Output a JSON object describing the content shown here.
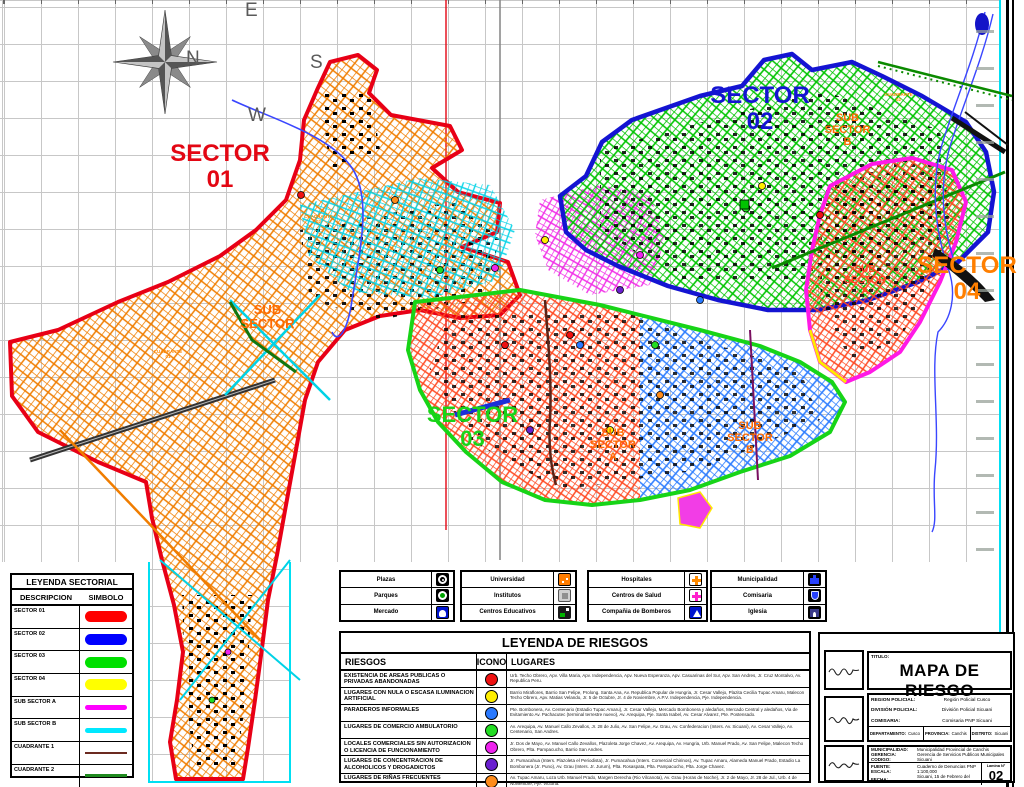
{
  "compass": {
    "n": "N",
    "e": "E",
    "s": "S",
    "w": "W"
  },
  "colors": {
    "sector01": "#e80016",
    "sector02": "#1414d2",
    "sector03": "#17d417",
    "sector04_label": "#ff7f00",
    "sub_sector_label": "#ff6a00",
    "grid": "#c7c7c7",
    "frame_cyan": "#00dff2"
  },
  "map_labels": {
    "sector01": {
      "line1": "SECTOR",
      "line2": "01",
      "color": "#e30613"
    },
    "sector02": {
      "line1": "SECTOR",
      "line2": "02",
      "color": "#1414d2"
    },
    "sector03": {
      "line1": "SECTOR",
      "line2": "03",
      "color": "#19d419"
    },
    "sector04": {
      "line1": "SECTOR",
      "line2": "04",
      "color": "#ff7f00"
    },
    "sub_sector_left": {
      "line1": "SUB",
      "line2": "SECTOR",
      "line3": "",
      "color": "#ff6a00"
    },
    "sub_sector_b_top": {
      "line1": "SUB",
      "line2": "SECTOR",
      "line3": "B",
      "color": "#ff6a00"
    },
    "sub_sector_a_mid": {
      "line1": "SUB",
      "line2": "SECTOR",
      "line3": "A",
      "color": "#ff6a00"
    },
    "sub_sector_b_mid": {
      "line1": "SUB",
      "line2": "SECTOR",
      "line3": "B",
      "color": "#ff6a00"
    },
    "sub_sector_a_right": {
      "line1": "SUB",
      "line2": "SECTOR",
      "line3": "A",
      "color": "#ff4422"
    },
    "cuadrante_01": {
      "line1": "CUADRANTE",
      "line2": "01",
      "color": "#ff8800"
    },
    "cuadrante_02": {
      "line1": "CUADRANTE",
      "line2": "02",
      "color": "#ff8800"
    },
    "cuadrante_02_ne": {
      "line1": "CUADRANTE",
      "line2": "02",
      "color": "#ff8800"
    }
  },
  "legend_sectorial": {
    "title": "LEYENDA SECTORIAL",
    "col_desc": "DESCRIPCION",
    "col_sym": "SIMBOLO",
    "rows": [
      {
        "label": "SECTOR 01",
        "color": "#ff0000",
        "style": "pill"
      },
      {
        "label": "SECTOR 02",
        "color": "#0000ff",
        "style": "pill"
      },
      {
        "label": "SECTOR 03",
        "color": "#00e000",
        "style": "pill"
      },
      {
        "label": "SECTOR 04",
        "color": "#ffff00",
        "style": "pill"
      },
      {
        "label": "SUB SECTOR A",
        "color": "#ff00ff",
        "style": "thin"
      },
      {
        "label": "SUB SECTOR B",
        "color": "#00e8ff",
        "style": "thin"
      },
      {
        "label": "CUADRANTE 1",
        "color": "#6b2a20",
        "style": "line"
      },
      {
        "label": "CUADRANTE 2",
        "color": "#1f8a1f",
        "style": "line"
      }
    ]
  },
  "legend_icons": {
    "groups": [
      [
        {
          "label": "Plazas",
          "icon": "plaza-icon"
        },
        {
          "label": "Parques",
          "icon": "park-icon"
        },
        {
          "label": "Mercado",
          "icon": "market-icon"
        }
      ],
      [
        {
          "label": "Universidad",
          "icon": "university-icon"
        },
        {
          "label": "Institutos",
          "icon": "institute-icon"
        },
        {
          "label": "Centros Educativos",
          "icon": "school-icon"
        }
      ],
      [
        {
          "label": "Hospitales",
          "icon": "hospital-icon"
        },
        {
          "label": "Centros de Salud",
          "icon": "health-center-icon"
        },
        {
          "label": "Compañia de Bomberos",
          "icon": "fire-station-icon"
        }
      ],
      [
        {
          "label": "Municipalidad",
          "icon": "town-hall-icon"
        },
        {
          "label": "Comisaria",
          "icon": "police-station-icon"
        },
        {
          "label": "Iglesia",
          "icon": "church-icon"
        }
      ]
    ]
  },
  "legend_riesgos": {
    "title": "LEYENDA DE RIESGOS",
    "col_riesgos": "RIESGOS",
    "col_icono": "ICONO",
    "col_lugares": "LUGARES",
    "rows": [
      {
        "riesgo": "EXISTENCIA DE AREAS PUBLICAS O PRIVADAS ABANDONADAS",
        "color": "#ee1111",
        "lugares": "Urb. Techo Obrero, Apv. Villa Maria, Apv. Independencia, Apv. Nueva Esperanza, Apv. Casuarinas del Sur, Apv. San Andres, Jr. Cruz Montalvo, Av. Republica Peru."
      },
      {
        "riesgo": "LUGARES CON NULA O ESCASA ILUMINACION ARTIFICIAL",
        "color": "#ffee00",
        "lugares": "Barrio Miraflores, Barrio San Felipe, Prolong. Santa Ana, Av. Republica Popular de Hungria, Jr. Cesar Vallejo, Plazita Cecilia Tupac Amaru, Malecon Techo Obrero, Apv. Matias Velando, Jr. 5 de Octubre, Jr. 4 de Noviembre, A.P.V. Independencia, Pje. Independencia."
      },
      {
        "riesgo": "PARADEROS INFORMALES",
        "color": "#2979ff",
        "lugares": "Pte. Bombonera, Av. Centenario (Estadio Tupac Amaru), Jr. Cesar Vallejo, Mercado Bombonera y aledaños, Mercado Central y aledaños, Via de Evitamiento Av. Pachacutec (terminal terrestre nuevo), Av. Arequipa, Pje. Santa Isabel, Av. Cesar Alvarez, Pte. Postensado."
      },
      {
        "riesgo": "LUGARES DE COMERCIO AMBULATORIO",
        "color": "#22dd22",
        "lugares": "Av. Arequipa, Av. Manuel Callo Zevallos, Jr. 28 de Julio, Av. San Felipe, Av. Grau, Av. Confederacion (Inters. Av. Sicuani), Av. Cesar Vallejo, Av. Centenario, San Andres."
      },
      {
        "riesgo": "LOCALES COMERCIALES SIN AUTORIZACION O LICENCIA DE FUNCIONAMIENTO",
        "color": "#ee22ee",
        "lugares": "Jr. Dos de Mayo, Av. Manuel Callo Zevallos, Plazoleta Jorge Chavez, Av. Arequipa, Av. Hungria, Urb. Manuel Prado, Av. San Felipe, Malecon Techo Obrero, Plta. Pampacucho, Barrio San Andres."
      },
      {
        "riesgo": "LUGARES DE CONCENTRACION DE ALCOHOLICOS Y DROGADICTOS",
        "color": "#6a1fd0",
        "lugares": "Jr. Pumacahua (Inters. Plazoleta el Periodista), Jr. Pumacahua (Inters. Comercial Chirinos), Av. Tupac Amaru, Alameda Manuel Prado, Estadio La Bombonera (Jr. Puno), Av. Grau (Inters. Jr. Jurum), Plta. Rosaspata, Plta. Pampacucho, Plta. Jorge Chavez."
      },
      {
        "riesgo": "LUGARES DE RIÑAS FRECUENTES",
        "color": "#ff8c1a",
        "lugares": "Av. Tupac Amaru, Loza Urb. Manuel Prado, Margen Derecha (Rio Vilcanota), Av. Grau (Horas de Noche), Jr. 2 de Mayo, Jr. 28 de Jul., Urb. 4 de Noviembre, Pje. Victoria."
      }
    ]
  },
  "title_block": {
    "titulo_label": "TITULO:",
    "titulo": "MAPA DE RIESGO",
    "region_label": "REGION POLICIAL:",
    "region": "Región Policial Cusco",
    "division_label": "DIVISIÓN POLICIAL:",
    "division": "División Policial Sicuani",
    "comisaria_label": "COMISARIA:",
    "comisaria": "Comisaria PNP Sicuani",
    "departamento_label": "DEPARTAMENTO:",
    "departamento": "Cusco",
    "provincia_label": "PROVINCIA:",
    "provincia": "Canchis",
    "distrito_label": "DISTRITO:",
    "distrito": "Sicuani",
    "municipalidad_label": "MUNICIPALIDAD:",
    "municipalidad": "Municipalidad Provincial de Canchis",
    "gerencia_label": "GERENCIA:",
    "gerencia": "Gerencia de Servicios Publicos Municipales",
    "codigo_label": "CODIGO:",
    "codigo": "Sicuani",
    "fuente_label": "FUENTE:",
    "fuente": "Cuaderno de Denuncias PNP",
    "escala_label": "ESCALA:",
    "escala": "1:100,000",
    "fecha_label": "FECHA:",
    "fecha": "Sicuani, 15 de Febrero del 2024",
    "lamina_label": "Lamina N°",
    "lamina": "02"
  }
}
